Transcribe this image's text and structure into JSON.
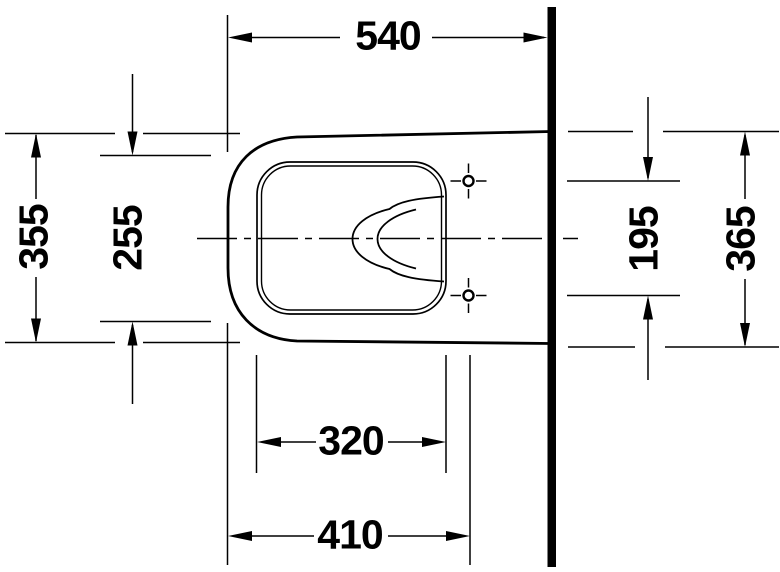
{
  "drawing": {
    "subject": "wall-hung-toilet-plan-view",
    "dimensions": [
      {
        "id": "top-width",
        "label": "540",
        "value": 540,
        "orientation": "horizontal"
      },
      {
        "id": "left-outer",
        "label": "355",
        "value": 355,
        "orientation": "vertical"
      },
      {
        "id": "left-inner",
        "label": "255",
        "value": 255,
        "orientation": "vertical"
      },
      {
        "id": "right-hole-span",
        "label": "195",
        "value": 195,
        "orientation": "vertical"
      },
      {
        "id": "right-outer",
        "label": "365",
        "value": 365,
        "orientation": "vertical"
      },
      {
        "id": "bottom-inner",
        "label": "320",
        "value": 320,
        "orientation": "horizontal"
      },
      {
        "id": "bottom-outer",
        "label": "410",
        "value": 410,
        "orientation": "horizontal"
      }
    ],
    "colors": {
      "line": "#000000",
      "background": "#ffffff"
    }
  }
}
